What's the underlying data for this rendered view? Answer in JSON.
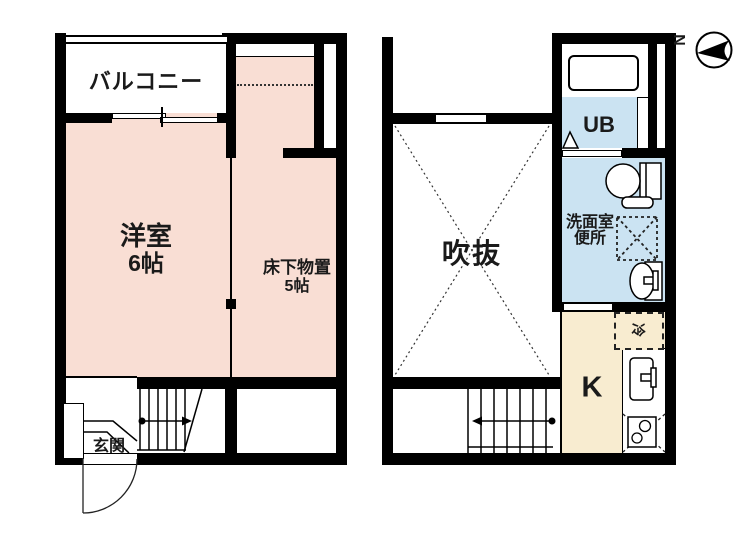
{
  "left_plan": {
    "balcony_label": "バルコニー",
    "room_label": "洋室",
    "room_size": "6帖",
    "storage_label": "床下物置",
    "storage_size": "5帖",
    "entrance_label": "玄関"
  },
  "right_plan": {
    "void_label": "吹抜",
    "unit_bath_label": "UB",
    "washroom_label": "洗面室",
    "toilet_label": "便所",
    "kitchen_label": "K",
    "refrigerator_label": "冷"
  },
  "compass": {
    "north_label": "N"
  },
  "colors": {
    "room_pink": "#f9ded4",
    "wet_area_blue": "#cbe3f2",
    "kitchen_cream": "#f8ecd0",
    "wall_black": "#000000"
  }
}
